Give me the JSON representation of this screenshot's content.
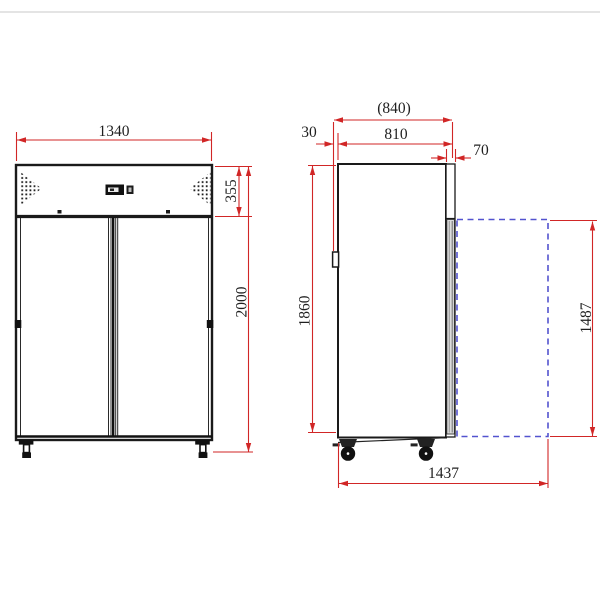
{
  "drawing": {
    "type": "technical-dimension-drawing",
    "subject": "double-door upright refrigerator, front and side views",
    "front_view": {
      "width_mm": "1340",
      "top_section_height_mm": "355",
      "overall_height_mm": "2000"
    },
    "side_view": {
      "overall_depth_mm": "(840)",
      "rear_clearance_mm": "30",
      "body_depth_mm": "810",
      "door_thickness_mm": "70",
      "body_height_mm": "1860",
      "door_height_mm": "1487",
      "depth_door_open_mm": "1437"
    },
    "colors": {
      "dimension_red": "#d12626",
      "door_swing_blue": "#5353cf",
      "line_black": "#1a1a1a"
    }
  }
}
